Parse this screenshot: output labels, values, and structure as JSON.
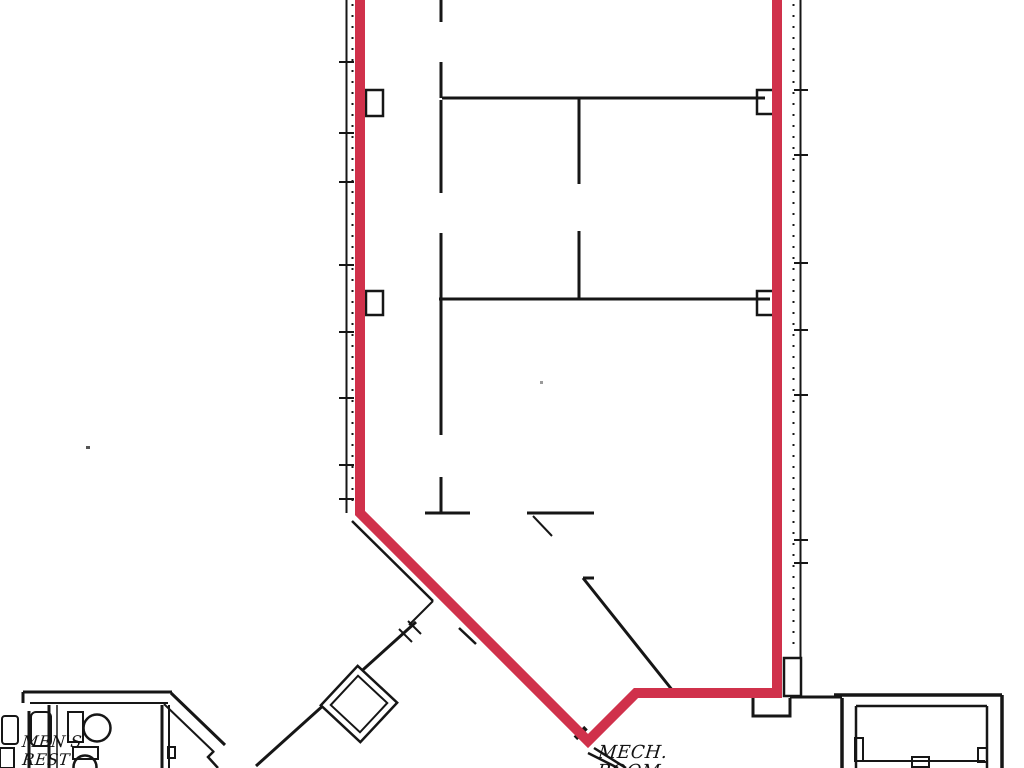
{
  "plan": {
    "title": "floor-plan",
    "highlight_color": "#d0314b",
    "line_color": "#161616",
    "background": "#ffffff",
    "rooms": {
      "mens_rest": {
        "line1": "MEN'S",
        "line2": "REST"
      },
      "mech_room": {
        "line1": "MECH.",
        "line2": "ROOM"
      }
    }
  }
}
